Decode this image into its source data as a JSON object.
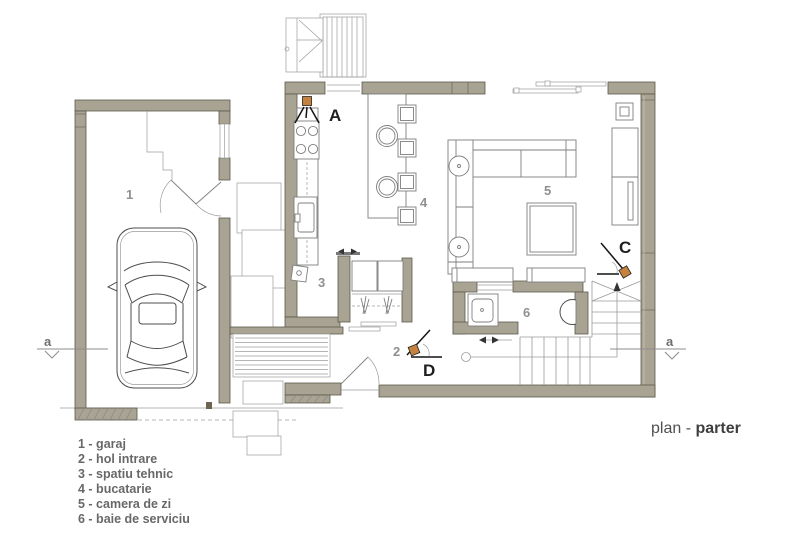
{
  "title": {
    "prefix": "plan - ",
    "emphasis": "parter"
  },
  "legend": {
    "items": [
      "1 - garaj",
      "2 - hol intrare",
      "3 - spatiu tehnic",
      "4 - bucatarie",
      "5 - camera de zi",
      "6 - baie de serviciu"
    ]
  },
  "rooms": {
    "garage": "1",
    "hall": "2",
    "tech": "3",
    "kitchen": "4",
    "living": "5",
    "bath": "6"
  },
  "view_markers": {
    "a": "A",
    "c": "C",
    "d": "D"
  },
  "section_markers": {
    "left": "a",
    "right": "a"
  },
  "colors": {
    "wall": "#a8a392",
    "marker_orange": "#c5813e"
  }
}
